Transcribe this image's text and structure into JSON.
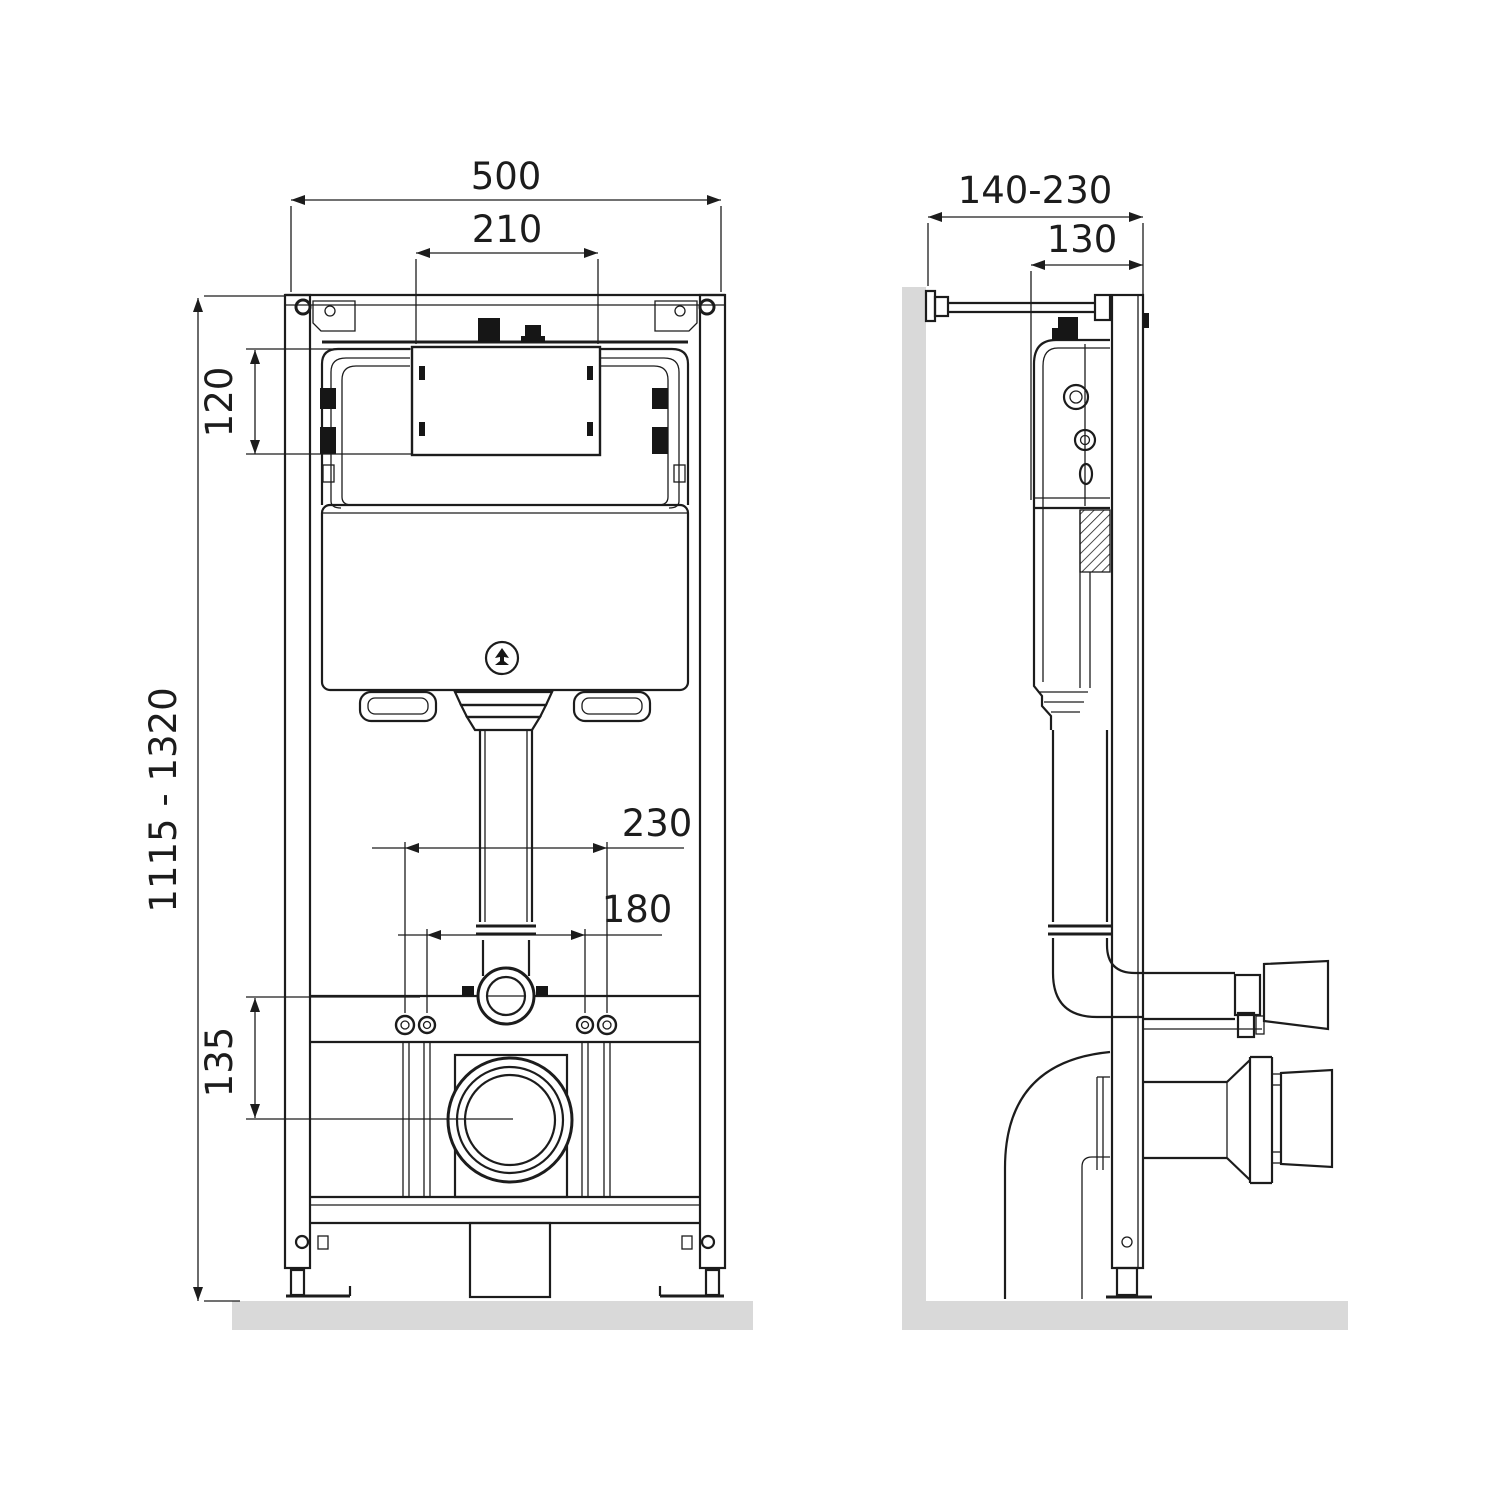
{
  "drawing": {
    "front_view": {
      "dims": {
        "frame_width": "500",
        "opening_width": "210",
        "opening_height": "120",
        "install_height_range": "1115 - 1320",
        "stud_spacing_outer": "230",
        "stud_spacing_inner": "180",
        "outlet_center_height": "135"
      }
    },
    "side_view": {
      "dims": {
        "wall_offset_range": "140-230",
        "frame_depth": "130"
      }
    },
    "colors": {
      "line": "#1c1c1c",
      "surface": "#d9d9d9",
      "black_fill": "#161616",
      "background": "#ffffff"
    }
  }
}
